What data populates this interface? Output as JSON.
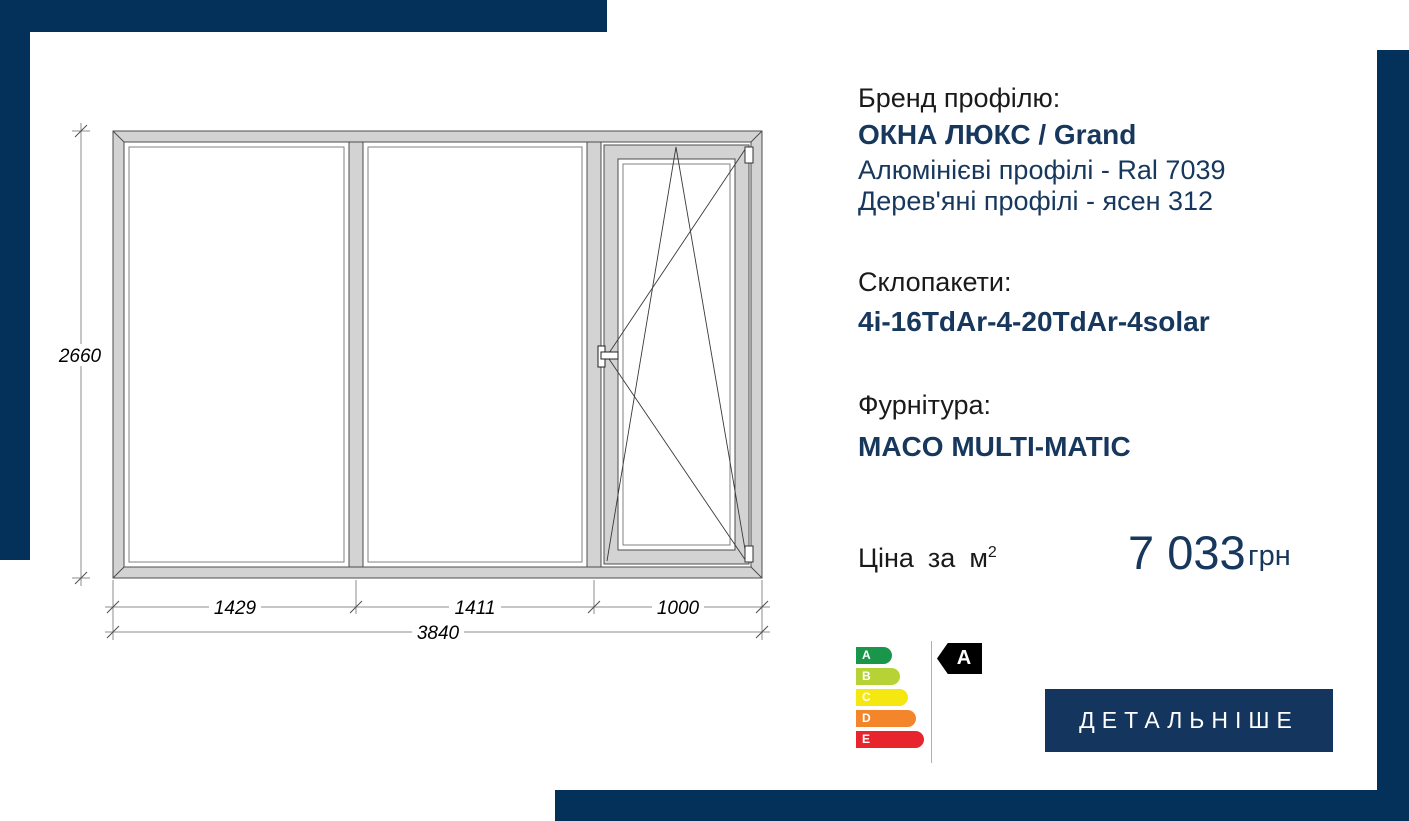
{
  "product": {
    "brand_label": "Бренд профілю:",
    "brand_name": "ОКНА ЛЮКС / Grand",
    "brand_detail_1": "Алюмінієві профілі - Ral 7039",
    "brand_detail_2": "Дерев'яні профілі - ясен  312",
    "glazing_label": "Склопакети:",
    "glazing_value": "4i-16TdAr-4-20TdAr-4solar",
    "hardware_label": "Фурнітура:",
    "hardware_value": "MACO MULTI-MATIC"
  },
  "price": {
    "label_word_1": "Ціна",
    "label_word_2": "за",
    "label_word_3": "м",
    "label_sup": "2",
    "value": "7 033",
    "currency": "грн"
  },
  "drawing": {
    "total_width_mm": "3840",
    "total_height_mm": "2660",
    "section_widths_mm": [
      "1429",
      "1411",
      "1000"
    ]
  },
  "energy": {
    "classes": [
      {
        "label": "A",
        "color": "#1a964a"
      },
      {
        "label": "B",
        "color": "#b5d334"
      },
      {
        "label": "C",
        "color": "#f4e810"
      },
      {
        "label": "D",
        "color": "#f3862a"
      },
      {
        "label": "E",
        "color": "#e8252c"
      }
    ],
    "rating": "A"
  },
  "cta": {
    "label": "ДЕТАЛЬНІШЕ"
  },
  "colors": {
    "accent_navy": "#04315a",
    "text_navy": "#17375d",
    "button_navy": "#14365e"
  }
}
